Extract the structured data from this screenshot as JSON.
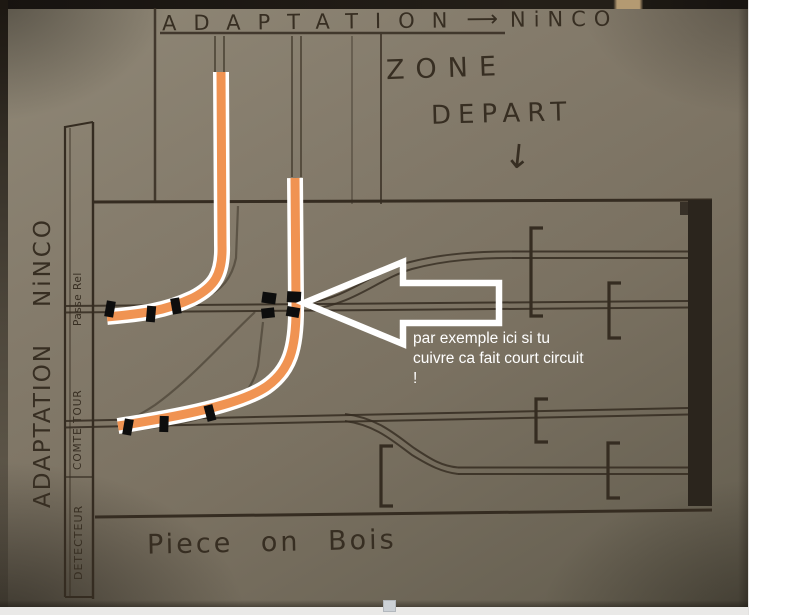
{
  "photo": {
    "top_banner": {
      "word_left": "ADAPTATION",
      "arrow": "⟶",
      "word_right": "NiNCO"
    },
    "zone_depart": {
      "line1": "ZONE",
      "line2": "DEPART",
      "down_arrow": "↓"
    },
    "side_label": {
      "word1": "ADAPTATION",
      "word2": "NiNCO"
    },
    "left_column": {
      "label_top": "Passe Rel",
      "label_middle": "COMTE TOUR",
      "label_bottom": "DETECTEUR"
    },
    "annotation": {
      "lines": [
        "par exemple ici si tu",
        "cuivre ca fait court circuit",
        "!"
      ],
      "color": "#ffffff"
    },
    "bottom_label": "Piece on Bois",
    "highlight_color": "#f09352",
    "ink_color": "#352c21",
    "paper_color": "#7e7666"
  }
}
